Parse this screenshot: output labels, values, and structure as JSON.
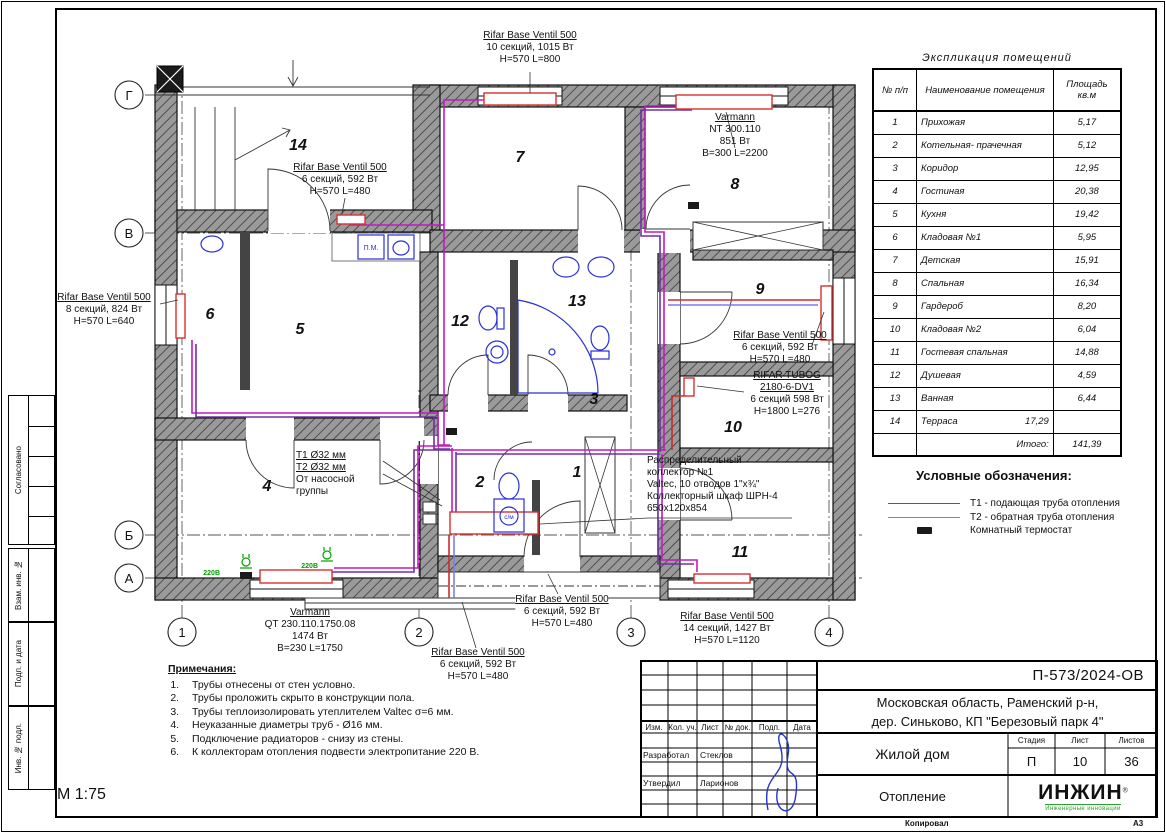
{
  "sheet": {
    "scale": "М 1:75",
    "copied_label": "Копировал",
    "format_label": "А3"
  },
  "side_strip": {
    "items": [
      "Согласовано",
      "Взам. инв. №",
      "Подп. и дата",
      "Инв. № подл."
    ]
  },
  "plan": {
    "axis_rows": [
      "Г",
      "В",
      "Б",
      "А"
    ],
    "axis_cols": [
      "1",
      "2",
      "3",
      "4"
    ],
    "room_numbers": [
      "1",
      "2",
      "3",
      "4",
      "5",
      "6",
      "7",
      "8",
      "9",
      "10",
      "11",
      "12",
      "13",
      "14"
    ],
    "fixtures": {
      "washer": "с/м",
      "dishwasher": "П.М.",
      "outlet1": "220В",
      "outlet2": "220В"
    },
    "labels": {
      "rad_top7": {
        "title": "Rifar Base Ventil 500",
        "rest": "10 секций, 1015 Вт\nН=570 L=800"
      },
      "rad_room8": {
        "title": "Varmann",
        "rest": "NT 300.110\n851 Вт\nВ=300 L=2200"
      },
      "rad_terrace": {
        "title": "Rifar Base Ventil 500",
        "rest": "6 секций, 592 Вт\nН=570 L=480"
      },
      "rad_room6": {
        "title": "Rifar Base Ventil 500",
        "rest": "8 секций, 824 Вт\nН=570 L=640"
      },
      "rad_room9": {
        "title": "Rifar Base Ventil 500",
        "rest": "6 секций, 592 Вт\nН=570 L=480"
      },
      "rad_tubog": {
        "title": "RIFAR TUBOG\n2180-6-DV1",
        "rest": "6 секций 598 Вт\nН=1800 L=276"
      },
      "collector": "Распределительный\nколлектор №1\nValtec, 10 отводов 1\"х¾\"\nКоллекторный шкаф ШРН-4\n650х120х854",
      "supply_t1": "Т1 Ø32 мм",
      "supply_t2": "Т2 Ø32 мм",
      "supply_rest": "От насосной\nгруппы",
      "rad_room4": {
        "title": "Varmann",
        "rest": "QT 230.110.1750.08\n1474 Вт\nВ=230 L=1750"
      },
      "rad_hall": {
        "title": "Rifar Base Ventil 500",
        "rest": "6 секций, 592 Вт\nН=570 L=480"
      },
      "rad_hall2": {
        "title": "Rifar Base Ventil 500",
        "rest": "6 секций, 592 Вт\nН=570 L=480"
      },
      "rad_room11": {
        "title": "Rifar Base Ventil 500",
        "rest": "14 секций, 1427 Вт\nН=570 L=1120"
      }
    },
    "colors": {
      "t1_pipe": "#cf2b2b",
      "t2_pipe": "#7b7bf0",
      "trunk_pipe": "#c518c5",
      "trunk_pipe2": "#7030a0",
      "radiator": "#d83030",
      "sanitary": "#2830d8",
      "outlet": "#00a000",
      "wall_fill": "#9a9a9a",
      "thermostat": "#1a1a1a"
    }
  },
  "rooms_table": {
    "title": "Экспликация помещений",
    "headers": {
      "num": "№ п/п",
      "name": "Наименование помещения",
      "area": "Площадь\nкв.м"
    },
    "rows": [
      {
        "num": "1",
        "name": "Прихожая",
        "area": "5,17"
      },
      {
        "num": "2",
        "name": "Котельная- прачечная",
        "area": "5,12"
      },
      {
        "num": "3",
        "name": "Коридор",
        "area": "12,95"
      },
      {
        "num": "4",
        "name": "Гостиная",
        "area": "20,38"
      },
      {
        "num": "5",
        "name": "Кухня",
        "area": "19,42"
      },
      {
        "num": "6",
        "name": "Кладовая №1",
        "area": "5,95"
      },
      {
        "num": "7",
        "name": "Детская",
        "area": "15,91"
      },
      {
        "num": "8",
        "name": "Спальная",
        "area": "16,34"
      },
      {
        "num": "9",
        "name": "Гардероб",
        "area": "8,20"
      },
      {
        "num": "10",
        "name": "Кладовая №2",
        "area": "6,04"
      },
      {
        "num": "11",
        "name": "Гостевая спальная",
        "area": "14,88"
      },
      {
        "num": "12",
        "name": "Душевая",
        "area": "4,59"
      },
      {
        "num": "13",
        "name": "Ванная",
        "area": "6,44"
      },
      {
        "num": "14",
        "name": "Терраса",
        "name_extra": "17,29",
        "area": ""
      }
    ],
    "total": {
      "label": "Итого:",
      "value": "141,39"
    }
  },
  "legend": {
    "title": "Условные обозначения:",
    "items": [
      {
        "label": "Т1 - подающая труба отопления",
        "color": "#cf2b2b",
        "type": "line"
      },
      {
        "label": "Т2 - обратная труба отопления",
        "color": "#7b7bf0",
        "type": "line"
      },
      {
        "label": "Комнатный термостат",
        "color": "#1a1a1a",
        "type": "rect"
      }
    ]
  },
  "notes": {
    "title": "Примечания:",
    "items": [
      "Трубы отнесены от стен условно.",
      "Трубы проложить скрыто в конструкции пола.",
      "Трубы теплоизолировать утеплителем Valtec σ=6 мм.",
      "Неуказанные диаметры труб - Ø16 мм.",
      "Подключение радиаторов - снизу из стены.",
      "К коллекторам отопления подвести электропитание 220 В."
    ]
  },
  "titleblock": {
    "doc_code": "П-573/2024-ОВ",
    "address": "Московская область, Раменский р-н,\nдер. Синьково, КП \"Березовый парк 4\"",
    "object_name": "Жилой дом",
    "sheet_title": "Отопление",
    "cols": [
      "Изм.",
      "Кол. уч.",
      "Лист",
      "№ док.",
      "Подп.",
      "Дата"
    ],
    "stage_label": "Стадия",
    "sheet_label": "Лист",
    "sheets_label": "Листов",
    "stage": "П",
    "sheet": "10",
    "sheets": "36",
    "developed_label": "Разработал",
    "developed_name": "Стеклов",
    "approved_label": "Утвердил",
    "approved_name": "Ларионов",
    "logo_text": "ИНЖИН",
    "logo_reg": "®",
    "logo_sub": "Инженерные инновации"
  }
}
